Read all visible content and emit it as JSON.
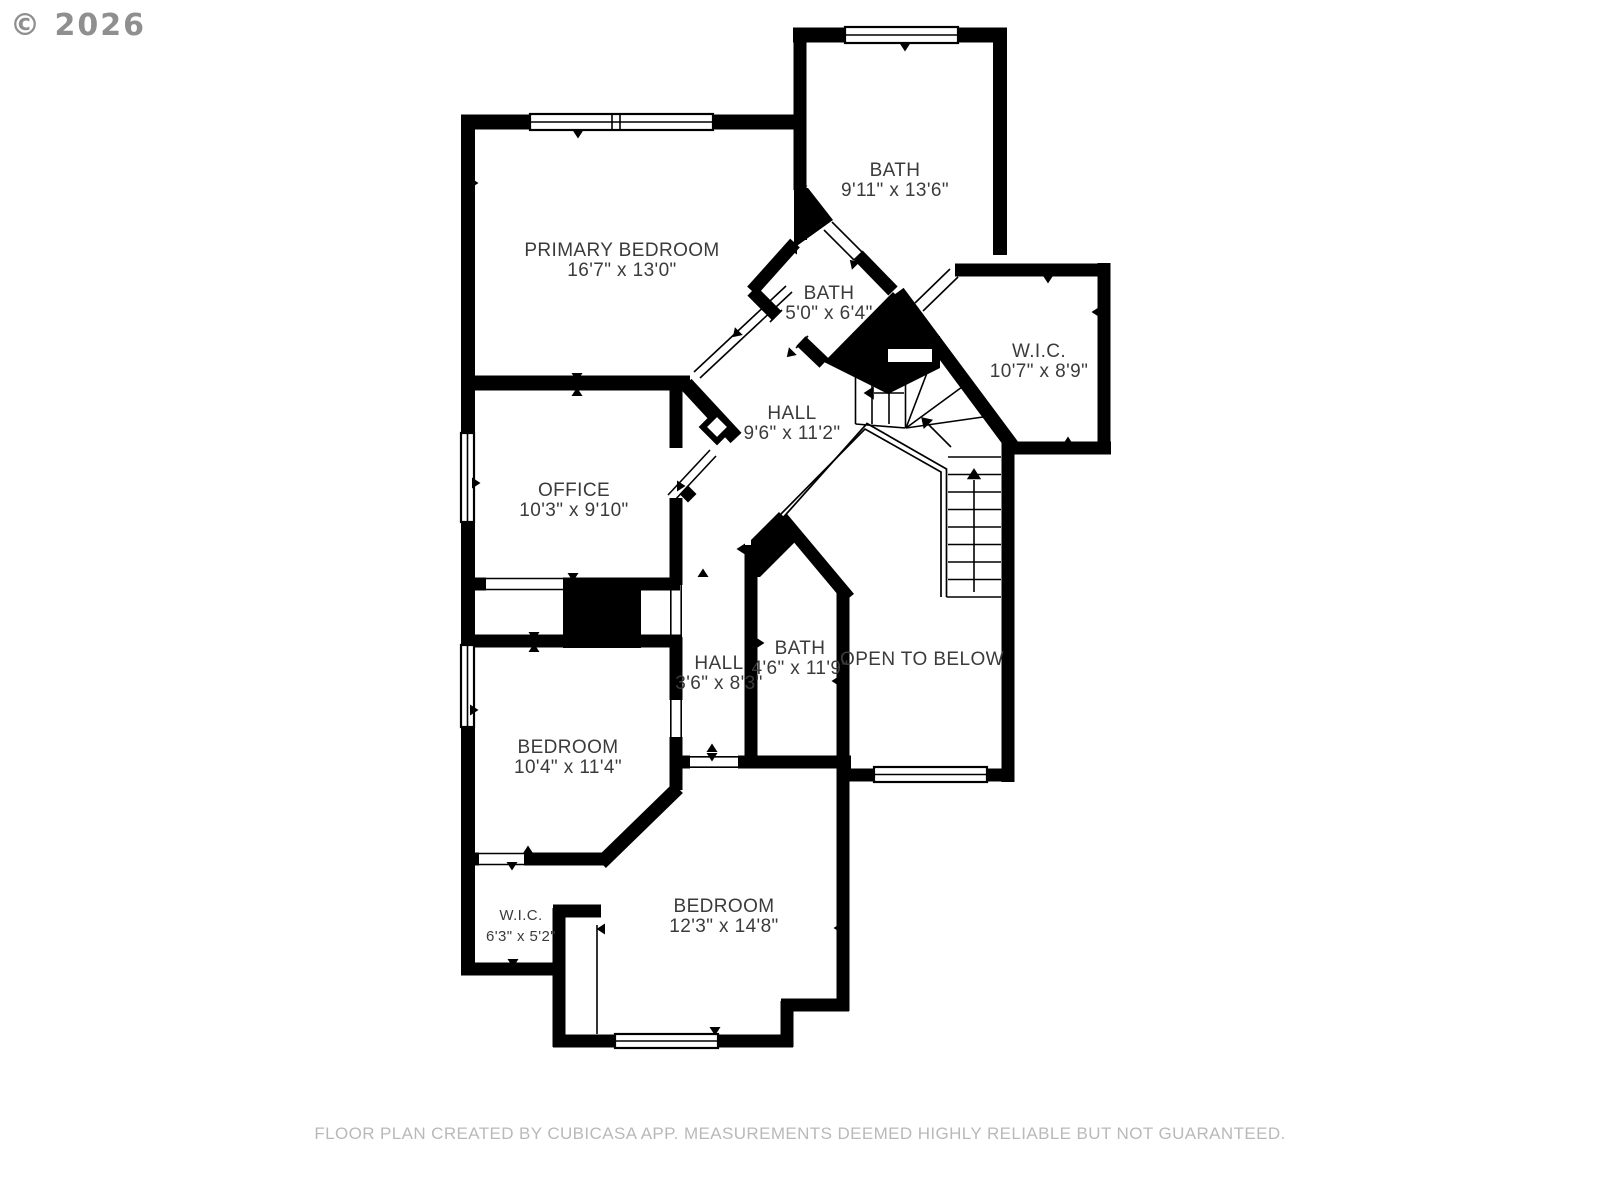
{
  "copyright": "© 2026",
  "footer": "FLOOR PLAN CREATED BY CUBICASA APP. MEASUREMENTS DEEMED HIGHLY RELIABLE BUT NOT GUARANTEED.",
  "colors": {
    "walls": "#000000",
    "room_text": "#3b3b3b",
    "footer_text": "#b9b9b9",
    "copyright_text": "#8f8f8f",
    "background": "#ffffff"
  },
  "rooms": [
    {
      "id": "bath-top",
      "name": "BATH",
      "dims": "9'11\" x 13'6\"",
      "cx": 895,
      "y1": 171,
      "y2": 191
    },
    {
      "id": "primary-bedroom",
      "name": "PRIMARY BEDROOM",
      "dims": "16'7\" x 13'0\"",
      "cx": 622,
      "y1": 251,
      "y2": 271
    },
    {
      "id": "bath-middle",
      "name": "BATH",
      "dims": "5'0\" x 6'4\"",
      "cx": 829,
      "y1": 294,
      "y2": 314
    },
    {
      "id": "wic-right",
      "name": "W.I.C.",
      "dims": "10'7\" x 8'9\"",
      "cx": 1039,
      "y1": 352,
      "y2": 372
    },
    {
      "id": "hall-upper",
      "name": "HALL",
      "dims": "9'6\" x 11'2\"",
      "cx": 792,
      "y1": 414,
      "y2": 434
    },
    {
      "id": "office",
      "name": "OFFICE",
      "dims": "10'3\" x 9'10\"",
      "cx": 574,
      "y1": 491,
      "y2": 511
    },
    {
      "id": "hall-lower",
      "name": "HALL",
      "dims": "3'6\" x 8'3\"",
      "cx": 719,
      "y1": 664,
      "y2": 684
    },
    {
      "id": "bath-lower",
      "name": "BATH",
      "dims": "4'6\" x 11'9\"",
      "cx": 800,
      "y1": 649,
      "y2": 669
    },
    {
      "id": "open-to-below",
      "name": "OPEN TO BELOW",
      "dims": "",
      "cx": 922,
      "y1": 660,
      "y2": null
    },
    {
      "id": "bedroom-left",
      "name": "BEDROOM",
      "dims": "10'4\" x 11'4\"",
      "cx": 568,
      "y1": 748,
      "y2": 768
    },
    {
      "id": "wic-left",
      "name": "W.I.C.",
      "dims": "6'3\" x 5'2\"",
      "cx": 521,
      "y1": 916,
      "y2": 937,
      "size": "small"
    },
    {
      "id": "bedroom-bottom",
      "name": "BEDROOM",
      "dims": "12'3\" x 14'8\"",
      "cx": 724,
      "y1": 907,
      "y2": 927
    }
  ]
}
